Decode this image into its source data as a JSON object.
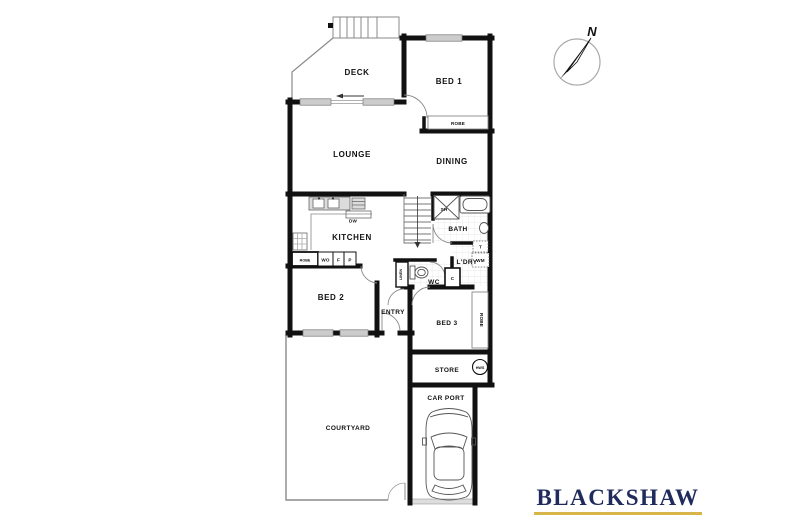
{
  "rooms": {
    "deck": "DECK",
    "bed1": "BED 1",
    "robe1": "ROBE",
    "lounge": "LOUNGE",
    "dining": "DINING",
    "kitchen": "KITCHEN",
    "bath": "BATH",
    "ldry": "L'DRY",
    "wc": "WC",
    "bed2": "BED 2",
    "entry": "ENTRY",
    "bed3": "BED 3",
    "robe3": "ROBE",
    "store": "STORE",
    "carport": "CAR PORT",
    "courtyard": "COURTYARD"
  },
  "labels": {
    "dw": "DW",
    "sh": "SH",
    "robe2": "ROBE",
    "wo": "WO",
    "f": "F",
    "p": "P",
    "linen": "LINEN",
    "c": "C",
    "t": "T",
    "wm": "WM",
    "hws": "HWS"
  },
  "compass": {
    "north": "N"
  },
  "branding": {
    "name": "BLACKSHAW"
  },
  "colors": {
    "wall": "#111111",
    "thin_line": "#8a8a8a",
    "window_fill": "#cccccc",
    "brand_navy": "#1f2b5c",
    "brand_gold": "#d8b54a"
  }
}
